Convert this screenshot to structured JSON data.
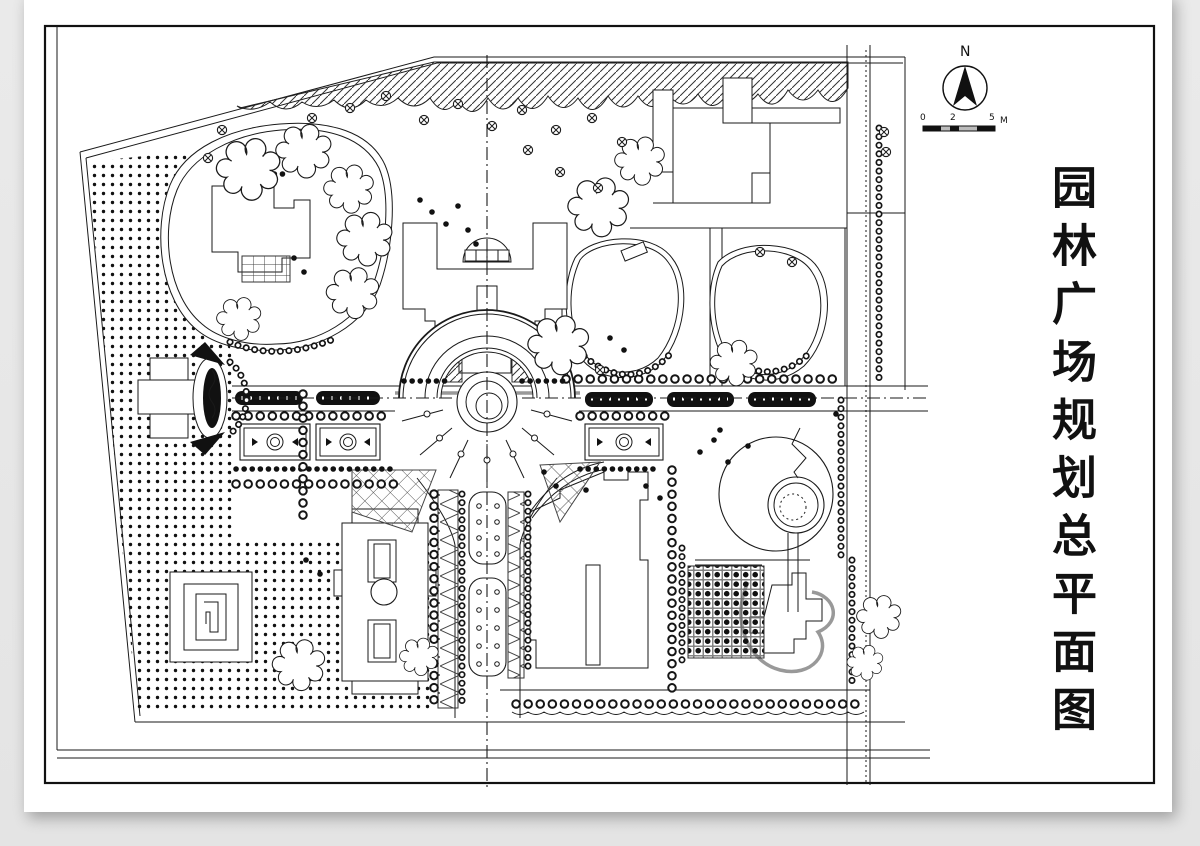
{
  "sheet": {
    "background": "#ececec",
    "paper": "#ffffff",
    "ink": "#1a1a1a",
    "title": "园林广场规划总平面图",
    "compass_label": "N",
    "scale": {
      "start": "0",
      "mid": "2",
      "end": "5",
      "unit": "M"
    }
  }
}
